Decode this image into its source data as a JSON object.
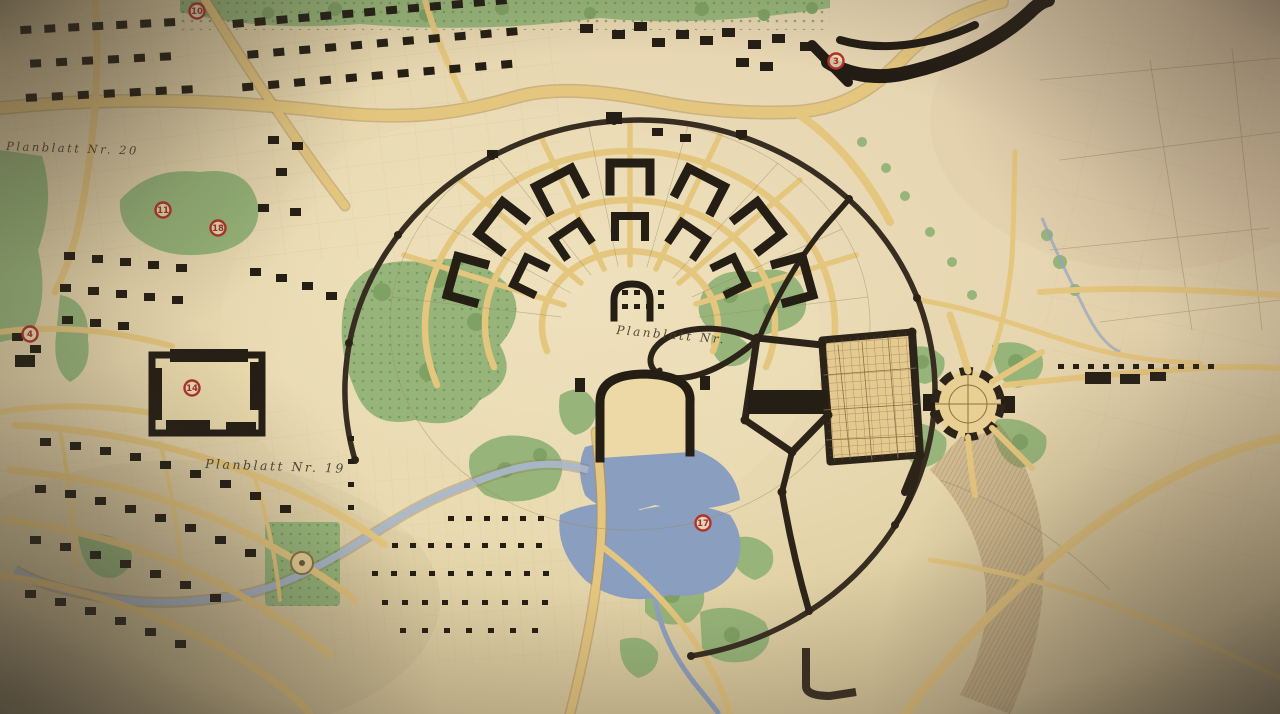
{
  "map": {
    "labels": {
      "planblatt_20": "Planblatt Nr. 20",
      "planblatt_19": "Planblatt Nr. 19",
      "planblatt_center": "Planblatt Nr."
    },
    "markers": [
      {
        "label": "10"
      },
      {
        "label": "11"
      },
      {
        "label": "18"
      },
      {
        "label": "4"
      },
      {
        "label": "14"
      },
      {
        "label": "3"
      },
      {
        "label": "17"
      }
    ],
    "colors": {
      "paper": "#e7d8ae",
      "paper_rose": "#e6d3c0",
      "road_tan": "#e5c67e",
      "vegetation": "#97b57a",
      "water": "#8b9fc0",
      "ink": "#241e14",
      "dark_road": "#372d20",
      "marker_red": "#b23229",
      "label_ink": "#453c2d"
    }
  }
}
